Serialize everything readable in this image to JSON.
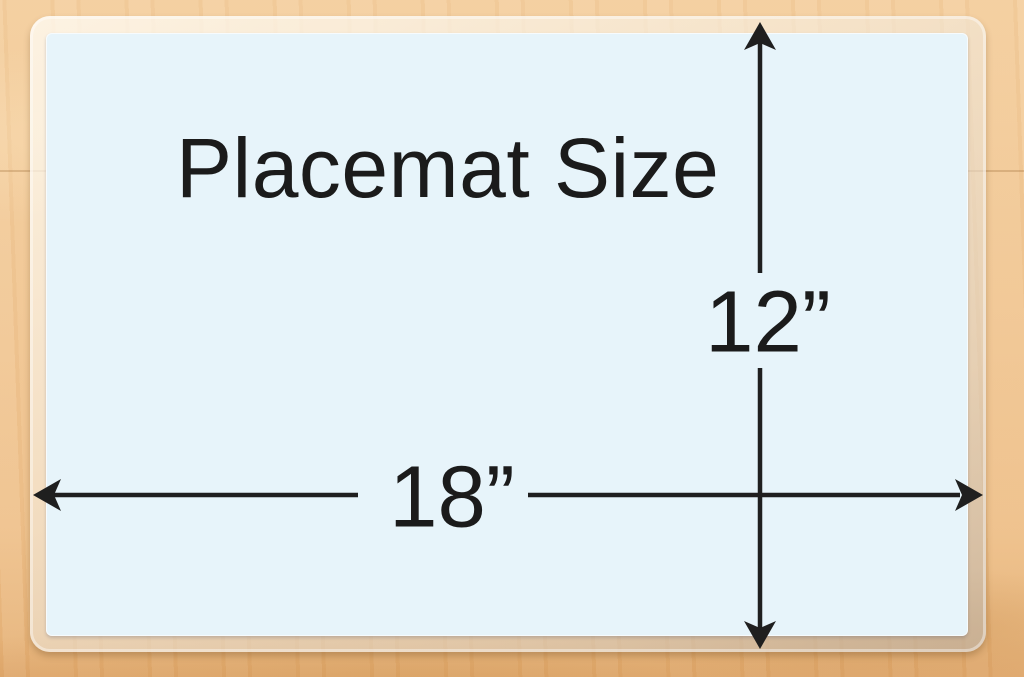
{
  "placemat": {
    "title": "Placemat Size",
    "width_label": "18”",
    "height_label": "12”",
    "width_inches": 18,
    "height_inches": 12
  },
  "colors": {
    "wood": "#f1c795",
    "wood_dark": "#dfa76c",
    "mat_blue": "#e7f4fa",
    "laminate": "#f3e7d3",
    "dimension_line": "#1f1f1f",
    "text": "#1b1b1b"
  }
}
